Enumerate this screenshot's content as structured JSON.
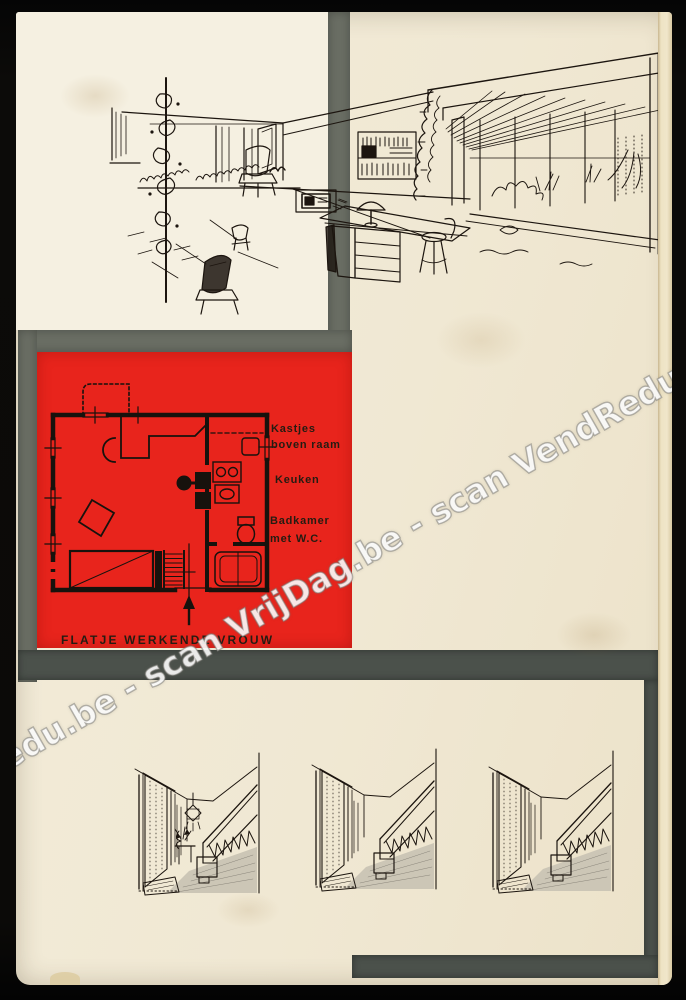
{
  "cover": {
    "watermark_text": "dRedu.be - scan VrijDag.be - scan VendRedu.be - sc",
    "floor_plan": {
      "label_cabinets_line1": "Kastjes",
      "label_cabinets_line2": "boven raam",
      "label_kitchen": "Keuken",
      "label_bathroom_line1": "Badkamer",
      "label_bathroom_line2": "met W.C.",
      "caption": "FLATJE WERKENDE VROUW"
    },
    "colors": {
      "paper": "#f1e9d5",
      "accent_red": "#e8241c",
      "divider_gray": "#6a6e64",
      "frame_gray": "#4b514b",
      "ink": "#1c150f",
      "photo_background": "#0b0a08"
    }
  }
}
